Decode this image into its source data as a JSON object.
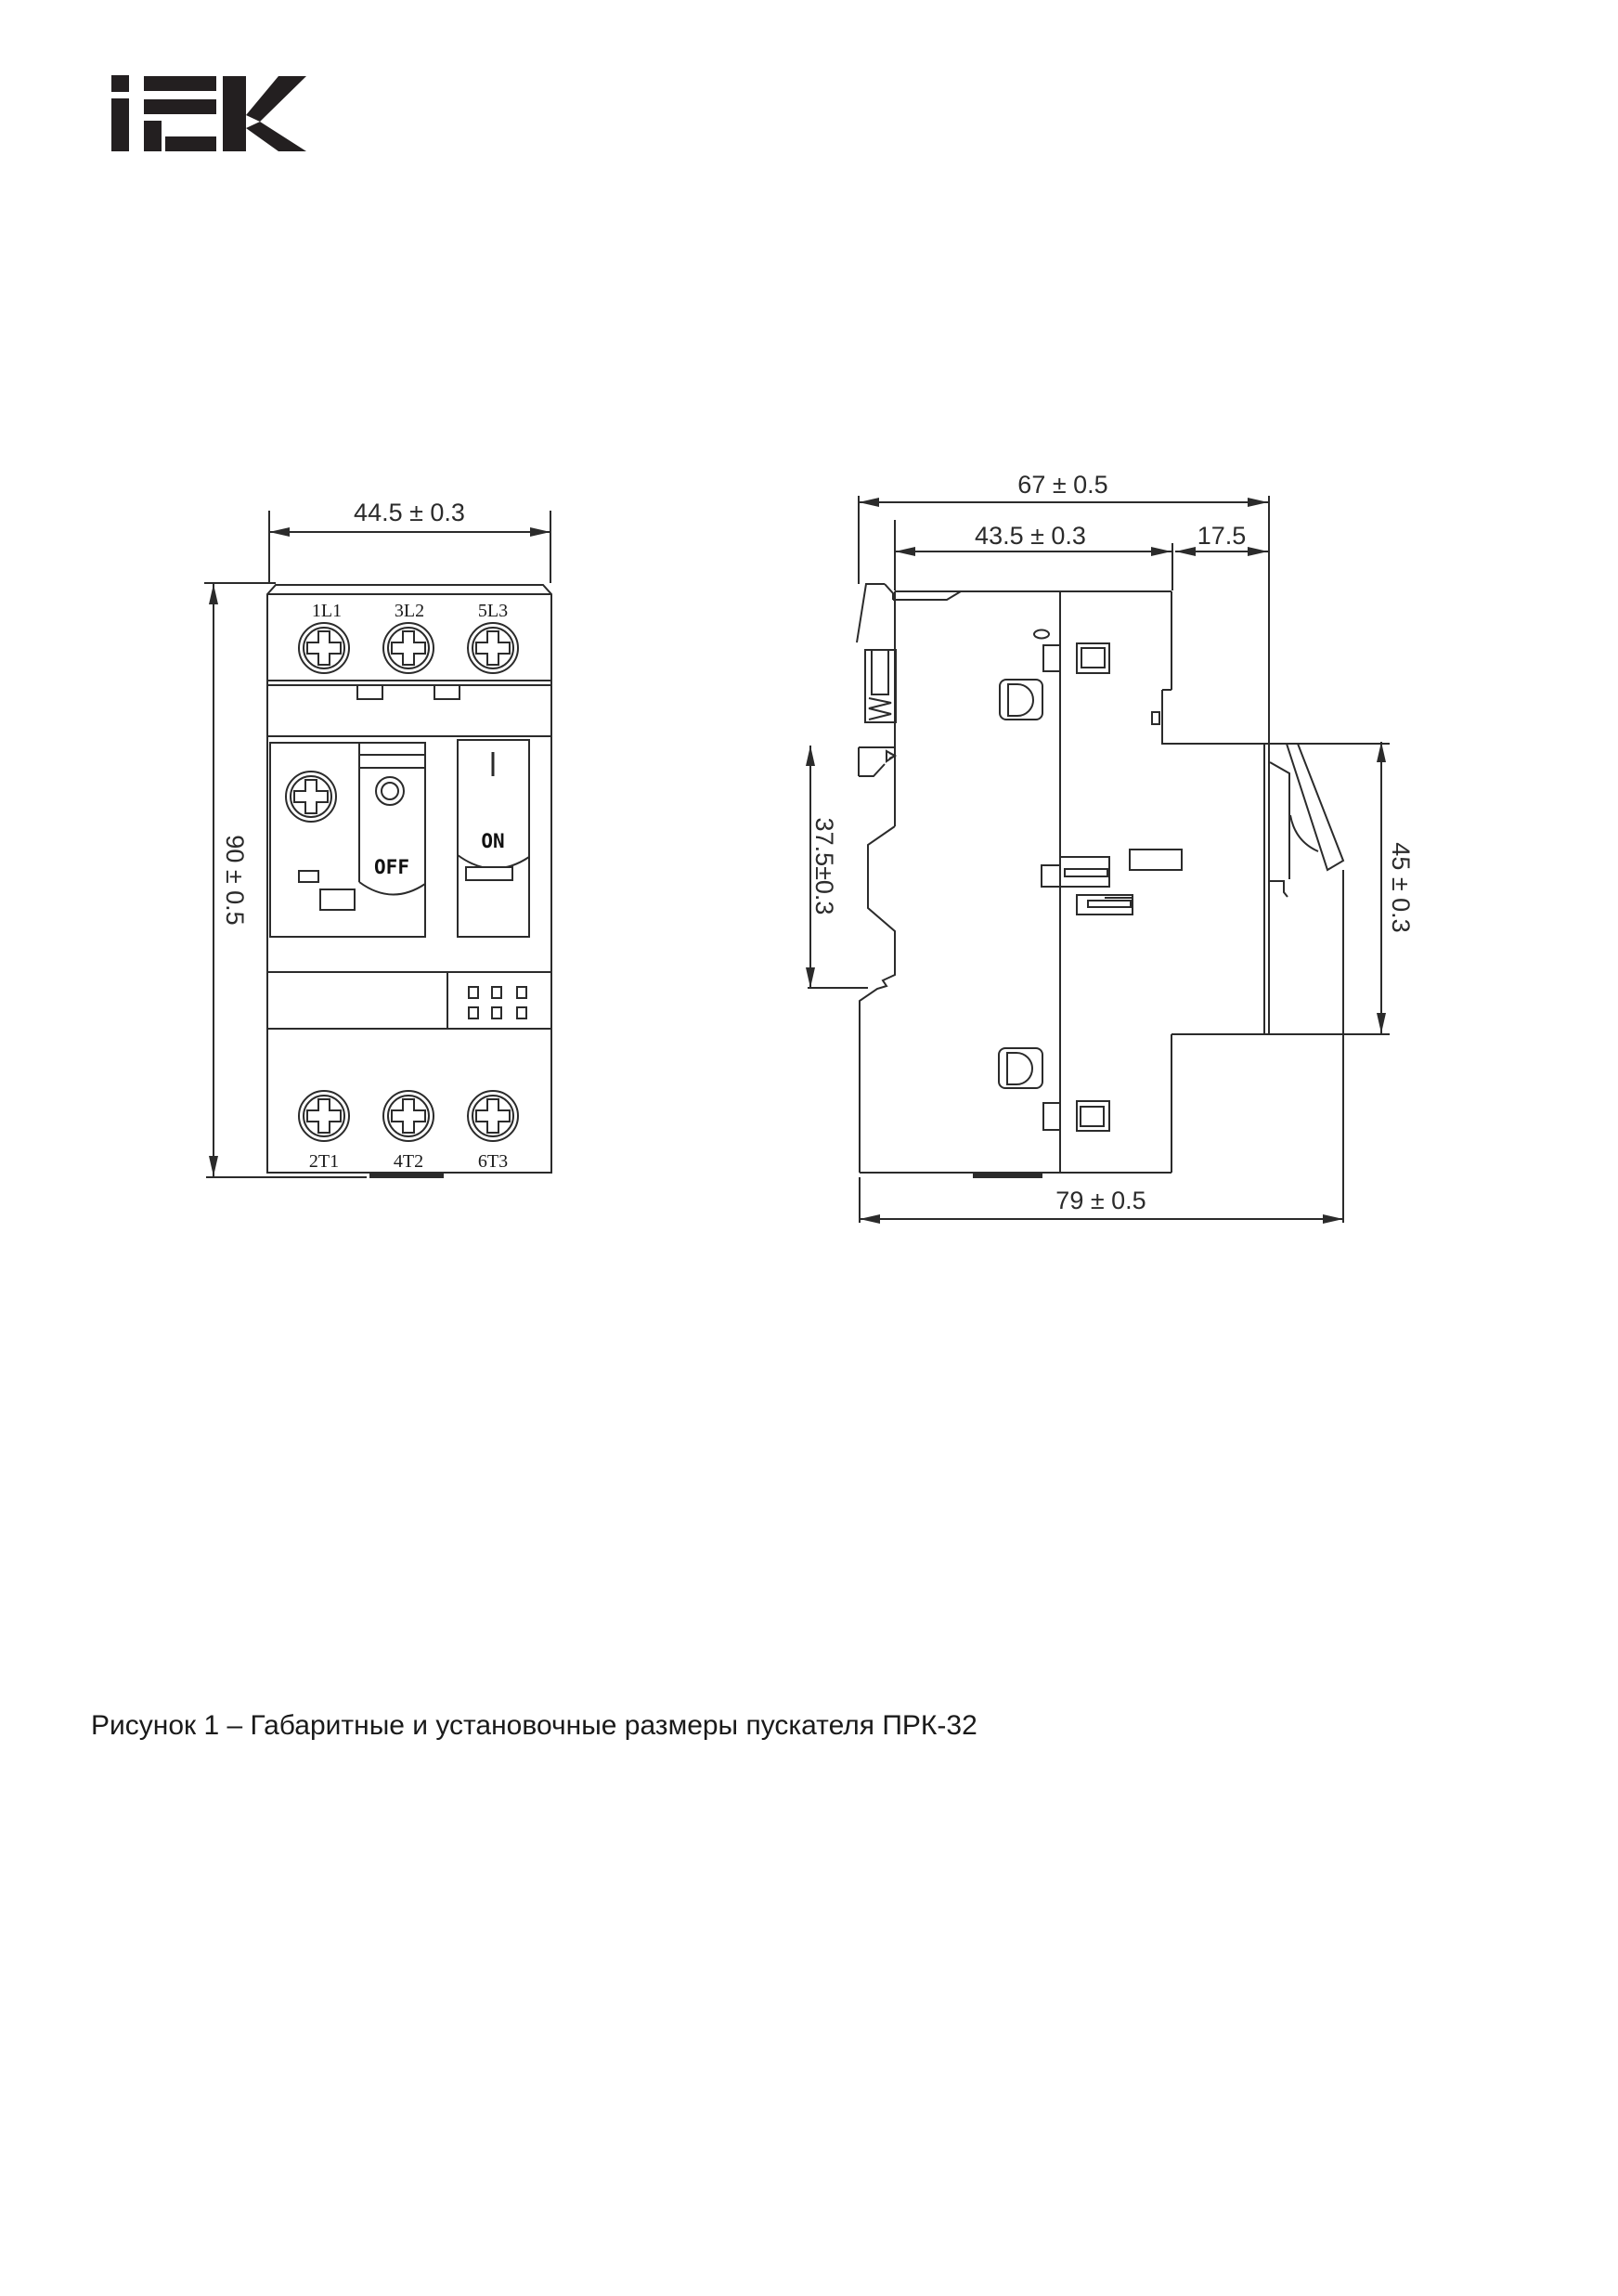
{
  "colors": {
    "background": "#ffffff",
    "line": "#2b2b2b",
    "text": "#1a1a1a",
    "logo": "#231f20"
  },
  "logo": {
    "brand": "IEK"
  },
  "front_view": {
    "terminals_top": [
      "1L1",
      "3L2",
      "5L3"
    ],
    "terminals_bottom": [
      "2T1",
      "4T2",
      "6T3"
    ],
    "off_label": "OFF",
    "on_label": "ON",
    "dim_width": "44.5 ± 0.3",
    "dim_height": "90 ± 0.5"
  },
  "side_view": {
    "dim_total_depth": "67 ± 0.5",
    "dim_body_depth": "43.5 ± 0.3",
    "dim_front_depth": "17.5",
    "dim_back_height": "37.5±0.3",
    "dim_front_height": "45 ± 0.3",
    "dim_total_length": "79 ± 0.5"
  },
  "caption": "Рисунок 1 – Габаритные и установочные размеры пускателя ПРК-32"
}
